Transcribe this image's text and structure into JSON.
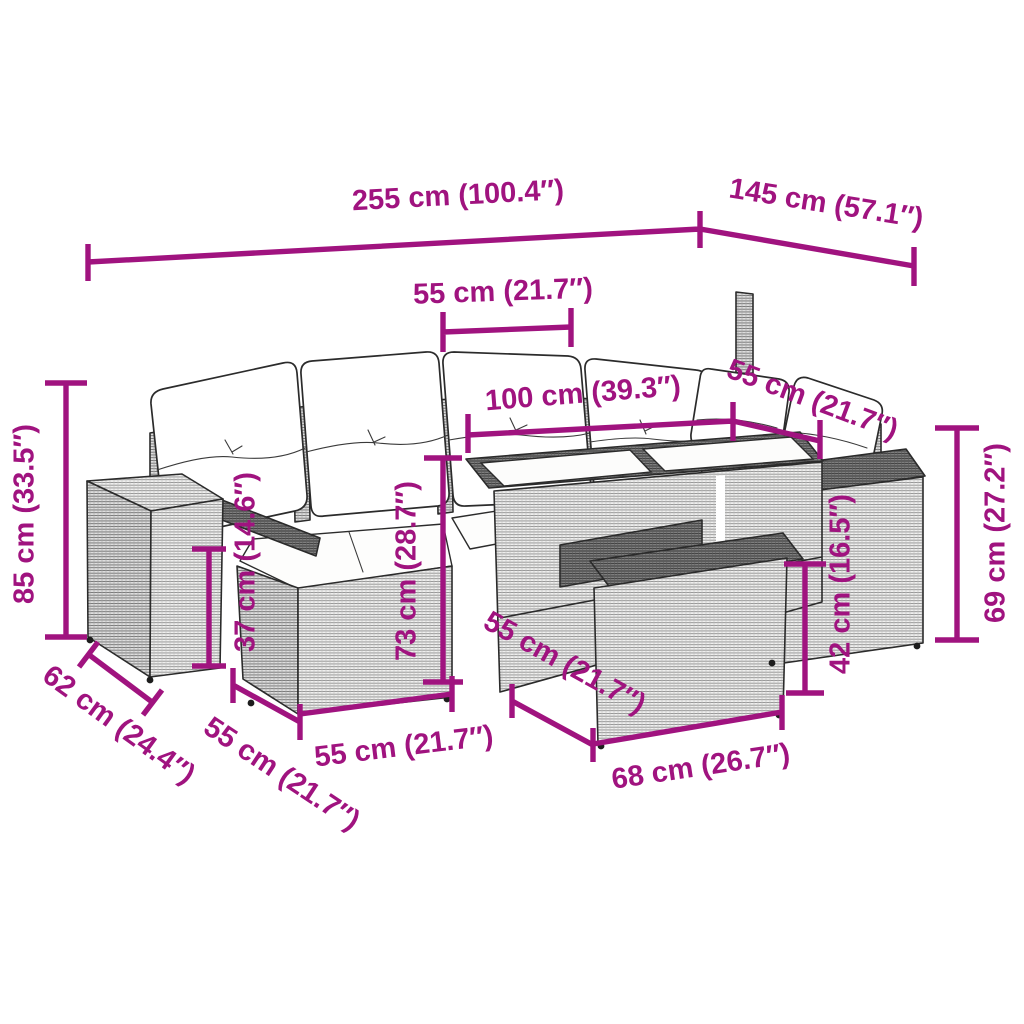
{
  "figure": {
    "description": "Rattan garden lounge set line drawing with back cushions, seat cushions, glass-top table and footstool blocks, annotated with magenta dimension lines",
    "accent_color": "#A0137F",
    "line_color": "#2b2b2b",
    "background_color": "#ffffff"
  },
  "dims": {
    "top_width": "255 cm (100.4″)",
    "top_depth": "145 cm (57.1″)",
    "seat_top": "55 cm (21.7″)",
    "back_run": "100 cm (39.3″)",
    "corner_run": "55 cm (21.7″)",
    "left_height": "85 cm (33.5″)",
    "seat_height": "37 cm (14.6″)",
    "mid_height": "73 cm (28.7″)",
    "footstool_height": "42 cm (16.5″)",
    "right_height": "69 cm (27.2″)",
    "left_depth": "62 cm (24.4″)",
    "left_seat_depth": "55 cm (21.7″)",
    "seat_front_width": "55 cm (21.7″)",
    "footstool_depth": "55 cm (21.7″)",
    "footstool_width": "68 cm (26.7″)"
  }
}
